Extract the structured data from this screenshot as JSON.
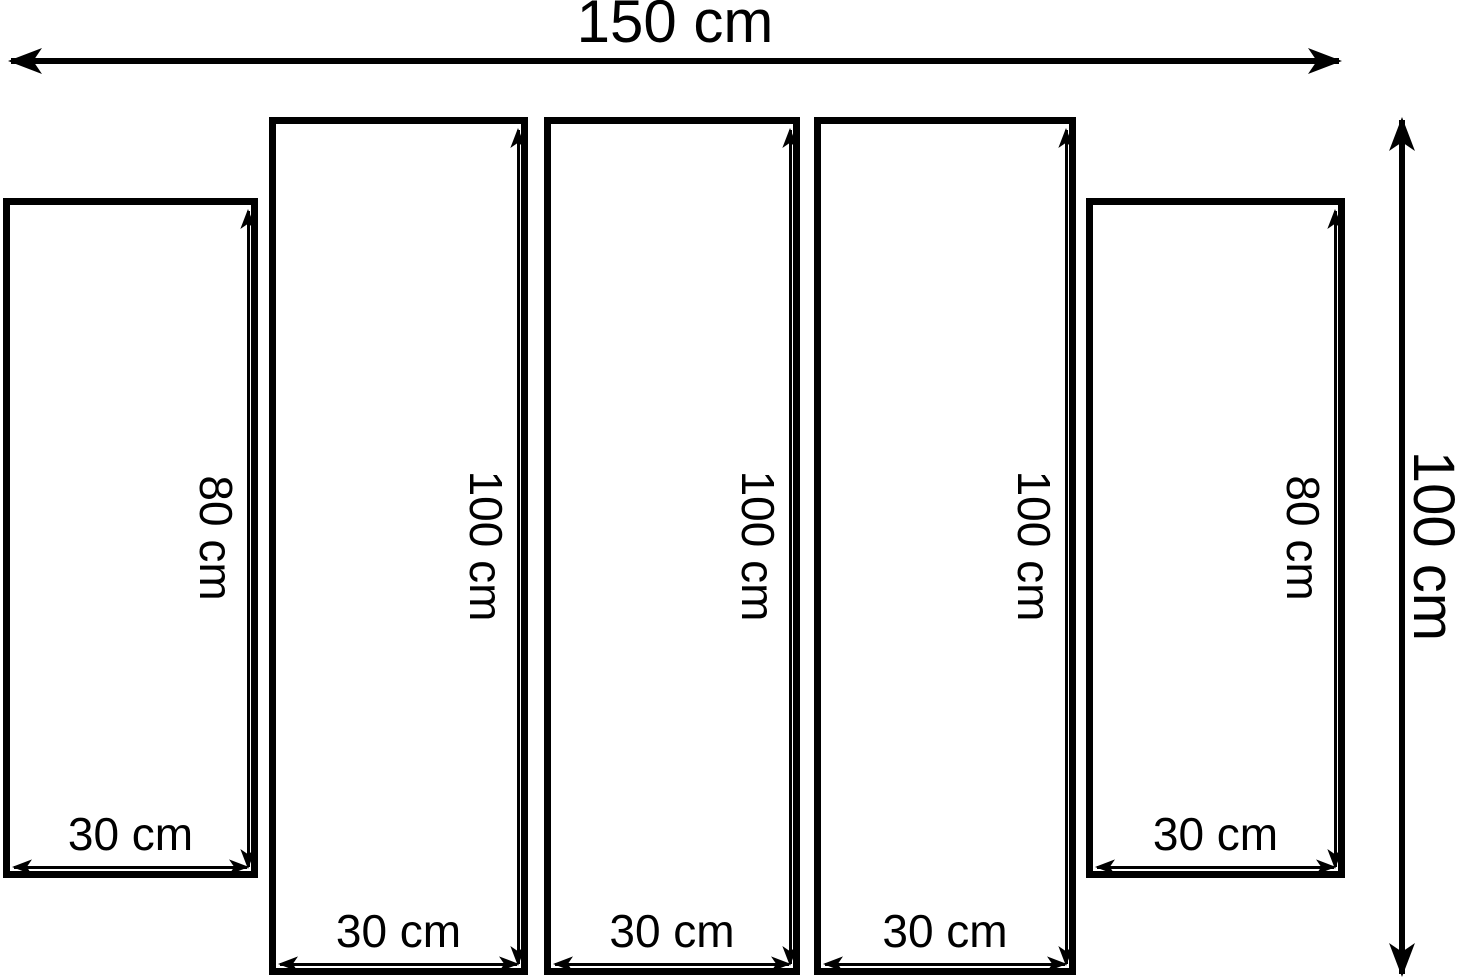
{
  "diagram": {
    "overall": {
      "width_label": "150 cm",
      "height_label": "100 cm"
    },
    "panels": [
      {
        "index": 1,
        "width_label": "30 cm",
        "height_label": "80 cm"
      },
      {
        "index": 2,
        "width_label": "30 cm",
        "height_label": "100 cm"
      },
      {
        "index": 3,
        "width_label": "30 cm",
        "height_label": "100 cm"
      },
      {
        "index": 4,
        "width_label": "30 cm",
        "height_label": "100 cm"
      },
      {
        "index": 5,
        "width_label": "30 cm",
        "height_label": "80 cm"
      }
    ],
    "colors": {
      "line": "#000000",
      "background": "#ffffff"
    }
  }
}
